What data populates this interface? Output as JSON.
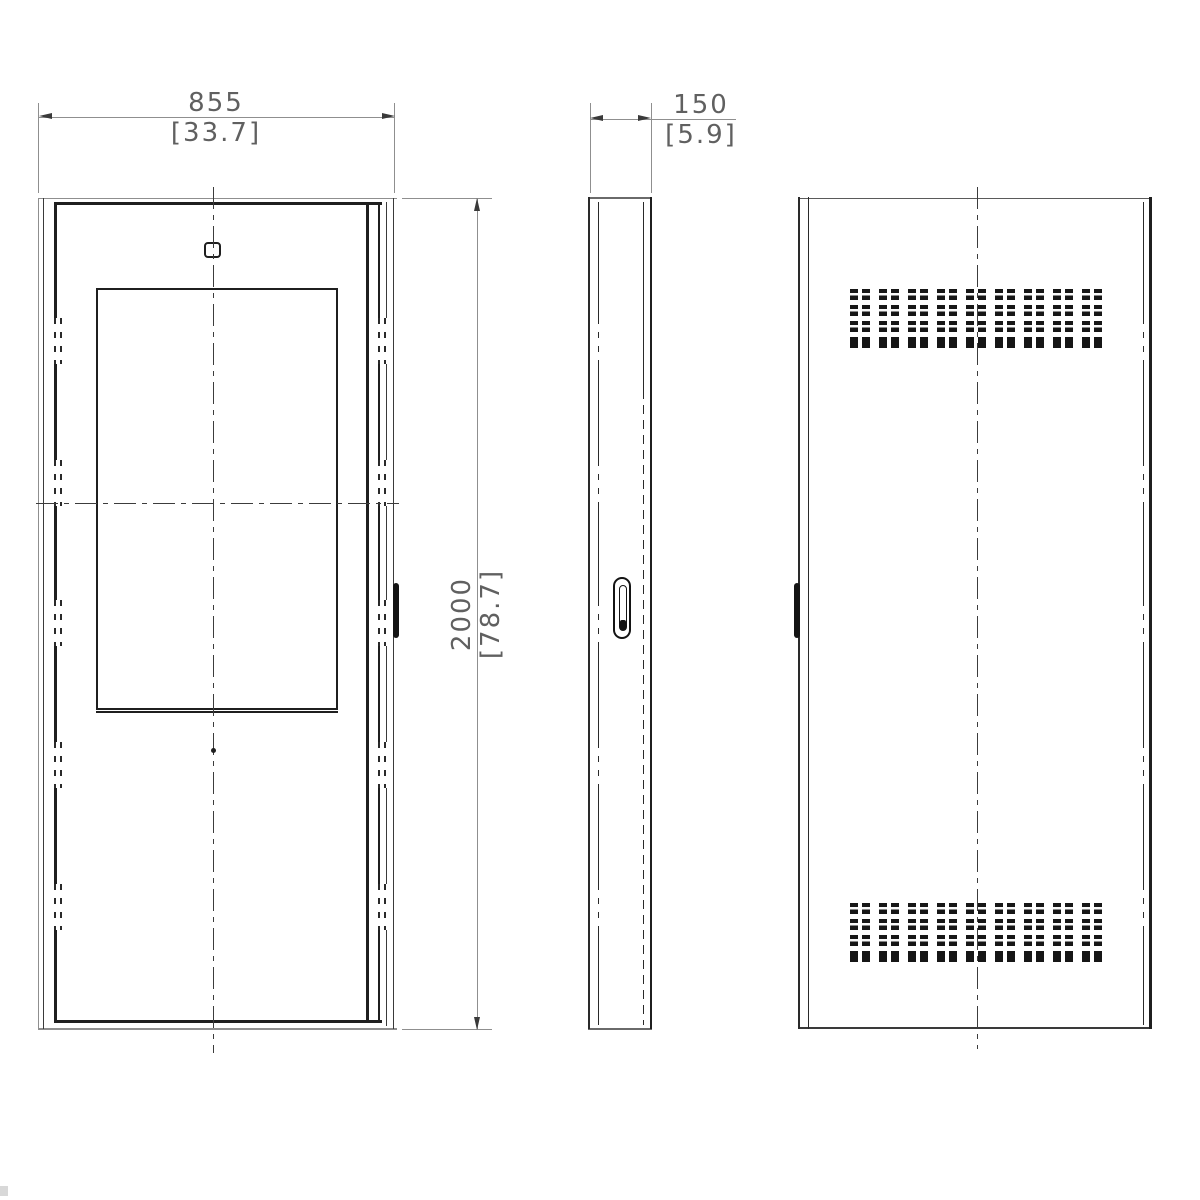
{
  "dimensions": {
    "width": {
      "primary": "855",
      "secondary": "[33.7]"
    },
    "depth": {
      "primary": "150",
      "secondary": "[5.9]"
    },
    "height": {
      "primary": "2000",
      "secondary": "[78.7]"
    }
  },
  "rear_view": {
    "vents": {
      "blocks": 2,
      "groups": 9,
      "cols": 2,
      "rows": 4
    }
  },
  "colors": {
    "line_dark": "#1f1f1f",
    "line_medium": "#3a3a3a",
    "line_light": "#8f8f8f",
    "dimension_text": "#606060",
    "vent_fill": "#161616"
  }
}
